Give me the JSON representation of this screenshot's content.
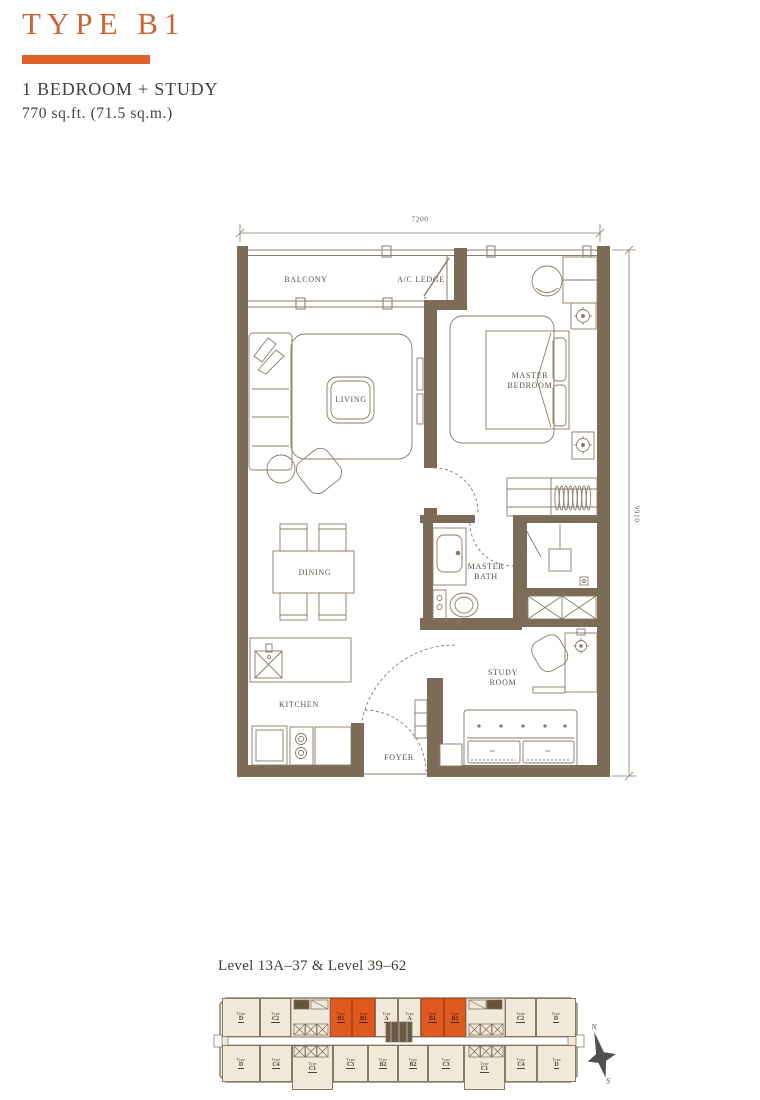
{
  "header": {
    "title": "TYPE B1",
    "subtitle": "1 BEDROOM + STUDY",
    "area": "770 sq.ft.  (71.5 sq.m.)",
    "accent_color": "#E2612B"
  },
  "floorplan": {
    "wall_color": "#7C6B56",
    "line_color": "#8A7A66",
    "labels": {
      "balcony": "BALCONY",
      "ac_ledge": "A/C LEDGE",
      "living": "LIVING",
      "master_bedroom": "MASTER BEDROOM",
      "dining": "DINING",
      "master_bath": "MASTER BATH",
      "study_room": "STUDY ROOM",
      "kitchen": "KITCHEN",
      "foyer": "FOYER"
    },
    "dimensions": {
      "width": "7200",
      "height": "9910"
    }
  },
  "keyplan": {
    "title": "Level 13A–37 & Level 39–62",
    "type_word": "Type",
    "highlight_color": "#E05A20",
    "unit_color": "#F0E8D9",
    "compass": {
      "north": "N",
      "south": "S"
    },
    "units": [
      {
        "code": "D",
        "x": 222,
        "y": 998,
        "w": 38,
        "h": 39,
        "highlighted": false
      },
      {
        "code": "C2",
        "x": 260,
        "y": 998,
        "w": 31,
        "h": 39,
        "highlighted": false
      },
      {
        "code": "B1",
        "x": 330,
        "y": 998,
        "w": 22,
        "h": 39,
        "highlighted": true
      },
      {
        "code": "B1",
        "x": 352,
        "y": 998,
        "w": 23,
        "h": 39,
        "highlighted": true
      },
      {
        "code": "A",
        "x": 375,
        "y": 998,
        "w": 23,
        "h": 39,
        "highlighted": false
      },
      {
        "code": "A",
        "x": 398,
        "y": 998,
        "w": 23,
        "h": 39,
        "highlighted": false
      },
      {
        "code": "B1",
        "x": 421,
        "y": 998,
        "w": 23,
        "h": 39,
        "highlighted": true
      },
      {
        "code": "B1",
        "x": 444,
        "y": 998,
        "w": 22,
        "h": 39,
        "highlighted": true
      },
      {
        "code": "C2",
        "x": 505,
        "y": 998,
        "w": 31,
        "h": 39,
        "highlighted": false
      },
      {
        "code": "D",
        "x": 536,
        "y": 998,
        "w": 40,
        "h": 39,
        "highlighted": false
      },
      {
        "code": "D",
        "x": 222,
        "y": 1045,
        "w": 38,
        "h": 37,
        "highlighted": false
      },
      {
        "code": "C4",
        "x": 260,
        "y": 1045,
        "w": 32,
        "h": 37,
        "highlighted": false
      },
      {
        "code": "C1",
        "x": 292,
        "y": 1045,
        "w": 41,
        "h": 45,
        "highlighted": false
      },
      {
        "code": "C3",
        "x": 333,
        "y": 1045,
        "w": 35,
        "h": 37,
        "highlighted": false
      },
      {
        "code": "B2",
        "x": 368,
        "y": 1045,
        "w": 30,
        "h": 37,
        "highlighted": false
      },
      {
        "code": "B2",
        "x": 398,
        "y": 1045,
        "w": 30,
        "h": 37,
        "highlighted": false
      },
      {
        "code": "C3",
        "x": 428,
        "y": 1045,
        "w": 36,
        "h": 37,
        "highlighted": false
      },
      {
        "code": "C1",
        "x": 464,
        "y": 1045,
        "w": 41,
        "h": 45,
        "highlighted": false
      },
      {
        "code": "C4",
        "x": 505,
        "y": 1045,
        "w": 32,
        "h": 37,
        "highlighted": false
      },
      {
        "code": "D",
        "x": 537,
        "y": 1045,
        "w": 39,
        "h": 37,
        "highlighted": false
      }
    ]
  }
}
